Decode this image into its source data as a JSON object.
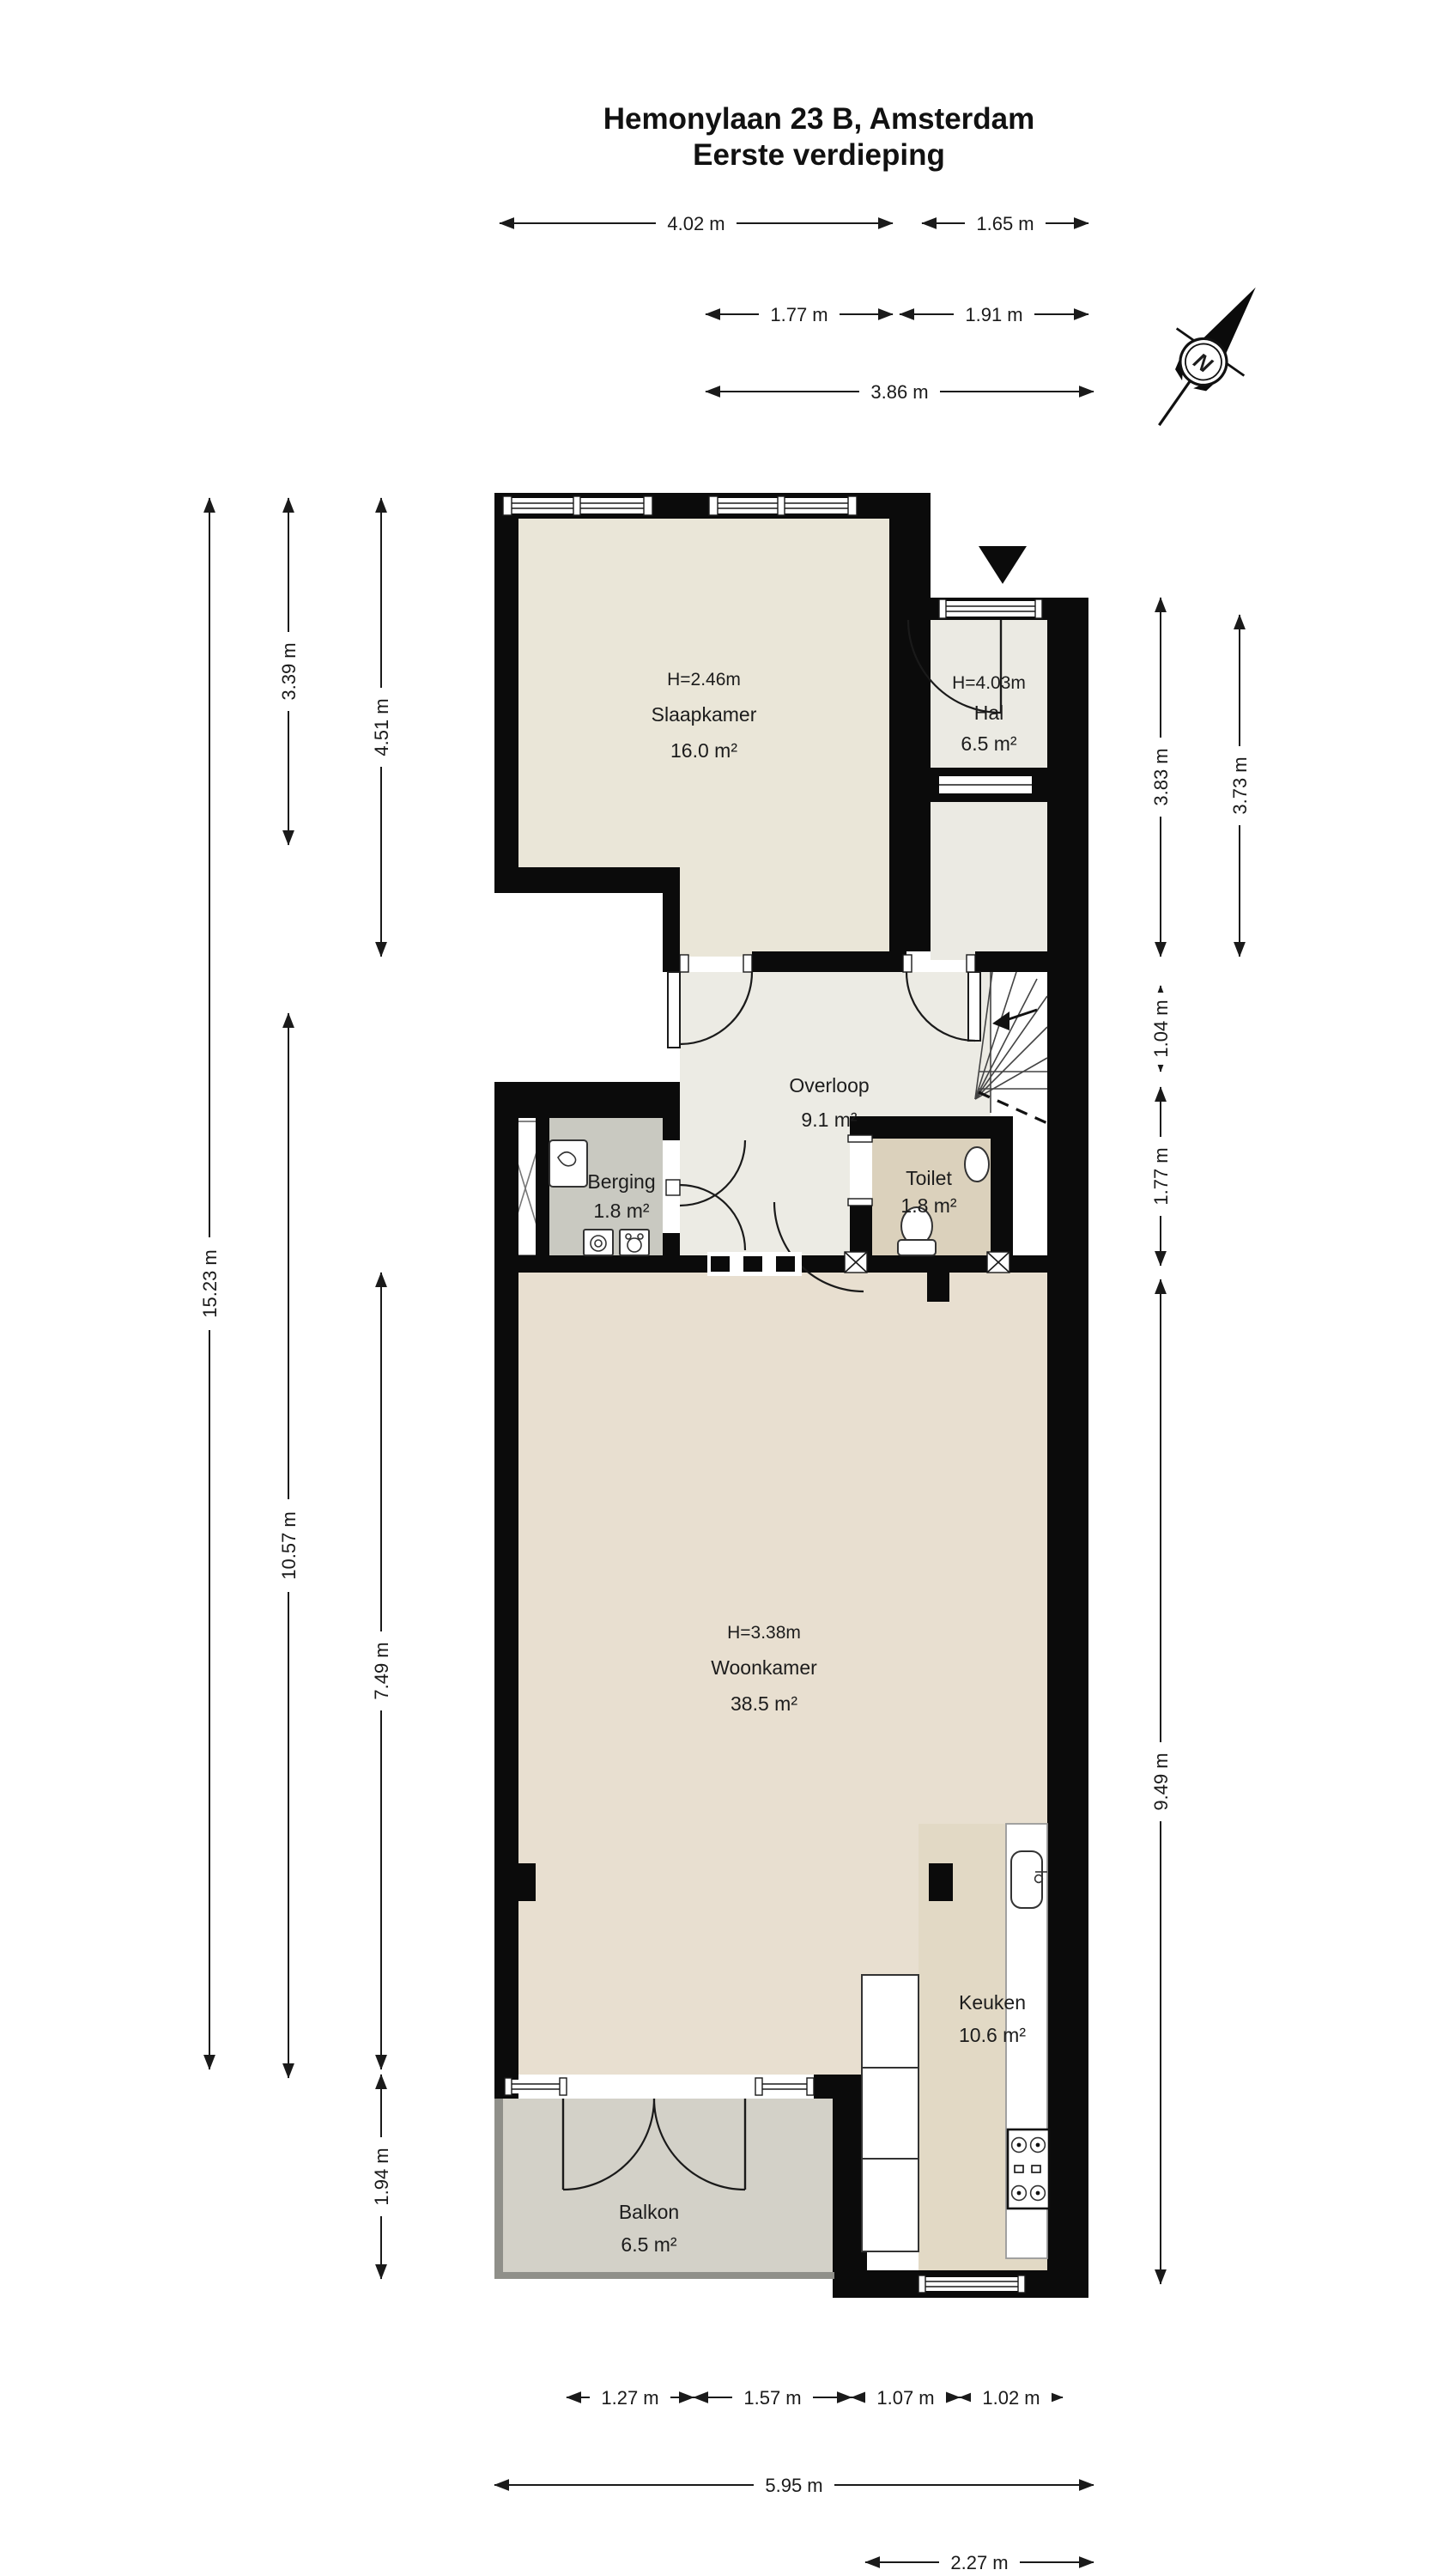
{
  "title": {
    "line1": "Hemonylaan 23 B, Amsterdam",
    "line2": "Eerste verdieping"
  },
  "compass": {
    "letter": "N"
  },
  "rooms": {
    "slaapkamer": {
      "height": "H=2.46m",
      "name": "Slaapkamer",
      "area": "16.0 m²"
    },
    "hal": {
      "height": "H=4.03m",
      "name": "Hal",
      "area": "6.5 m²"
    },
    "overloop": {
      "name": "Overloop",
      "area": "9.1 m²"
    },
    "toilet": {
      "name": "Toilet",
      "area": "1.8 m²"
    },
    "berging": {
      "name": "Berging",
      "area": "1.8 m²"
    },
    "woonkamer": {
      "height": "H=3.38m",
      "name": "Woonkamer",
      "area": "38.5 m²"
    },
    "keuken": {
      "name": "Keuken",
      "area": "10.6 m²"
    },
    "balkon": {
      "name": "Balkon",
      "area": "6.5 m²"
    }
  },
  "dims": {
    "top1": "4.02 m",
    "top2": "1.65 m",
    "top3": "1.77 m",
    "top4": "1.91 m",
    "top5": "3.86 m",
    "left1": "15.23 m",
    "left2": "3.39 m",
    "left3": "10.57 m",
    "left4": "4.51 m",
    "left5": "7.49 m",
    "left6": "1.94 m",
    "right1": "3.83 m",
    "right2": "3.73 m",
    "right3": "1.04 m",
    "right4": "1.77 m",
    "right5": "9.49 m",
    "bottom1": "1.27 m",
    "bottom2": "1.57 m",
    "bottom3": "1.07 m",
    "bottom4": "1.02 m",
    "bottom5": "5.95 m",
    "bottom6": "2.27 m"
  },
  "colors": {
    "wall": "#0b0b0b",
    "slaapkamer_floor": "#eae6d8",
    "hal_floor": "#ebeae3",
    "overloop_floor": "#ecebe4",
    "berging_floor": "#c9c9c1",
    "toilet_floor": "#dbd1bc",
    "woonkamer_floor": "#e8dfd0",
    "keuken_floor": "#e2d9c5",
    "balkon_floor": "#d3d1c8"
  }
}
